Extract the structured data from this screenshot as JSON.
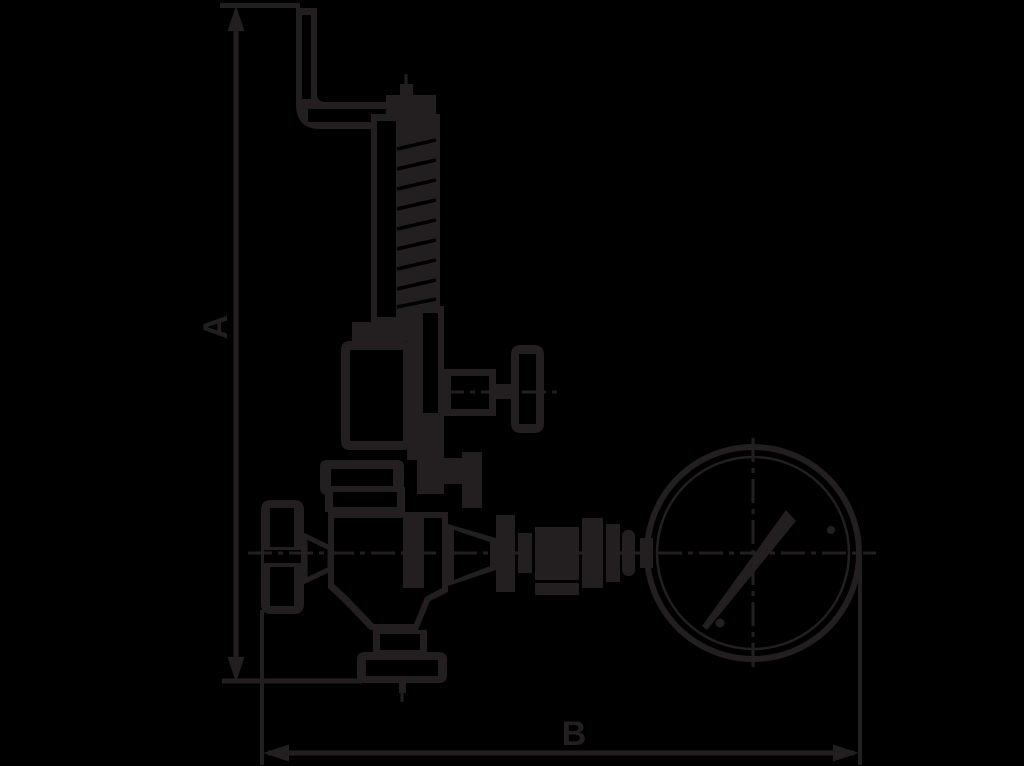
{
  "diagram": {
    "type": "technical-dimension-drawing",
    "subject": "spring-loaded relief valve with lever, handwheels and pressure gauge, side view",
    "background_color": "#000000",
    "line_color": "#231f20",
    "labels": {
      "height_dimension": "A",
      "width_dimension": "B"
    },
    "parts": [
      "lever-arm",
      "cap-nut",
      "spring-housing",
      "spring-coil",
      "housing-flange",
      "bonnet",
      "stem-column",
      "side-valve-body",
      "side-handwheel",
      "mid-flange",
      "valve-body",
      "left-handwheel",
      "stem-cone",
      "outlet-neck",
      "outlet-flange",
      "gauge-piping-fittings",
      "pressure-gauge",
      "gauge-needle",
      "centerlines",
      "dimension-a",
      "dimension-b"
    ]
  }
}
